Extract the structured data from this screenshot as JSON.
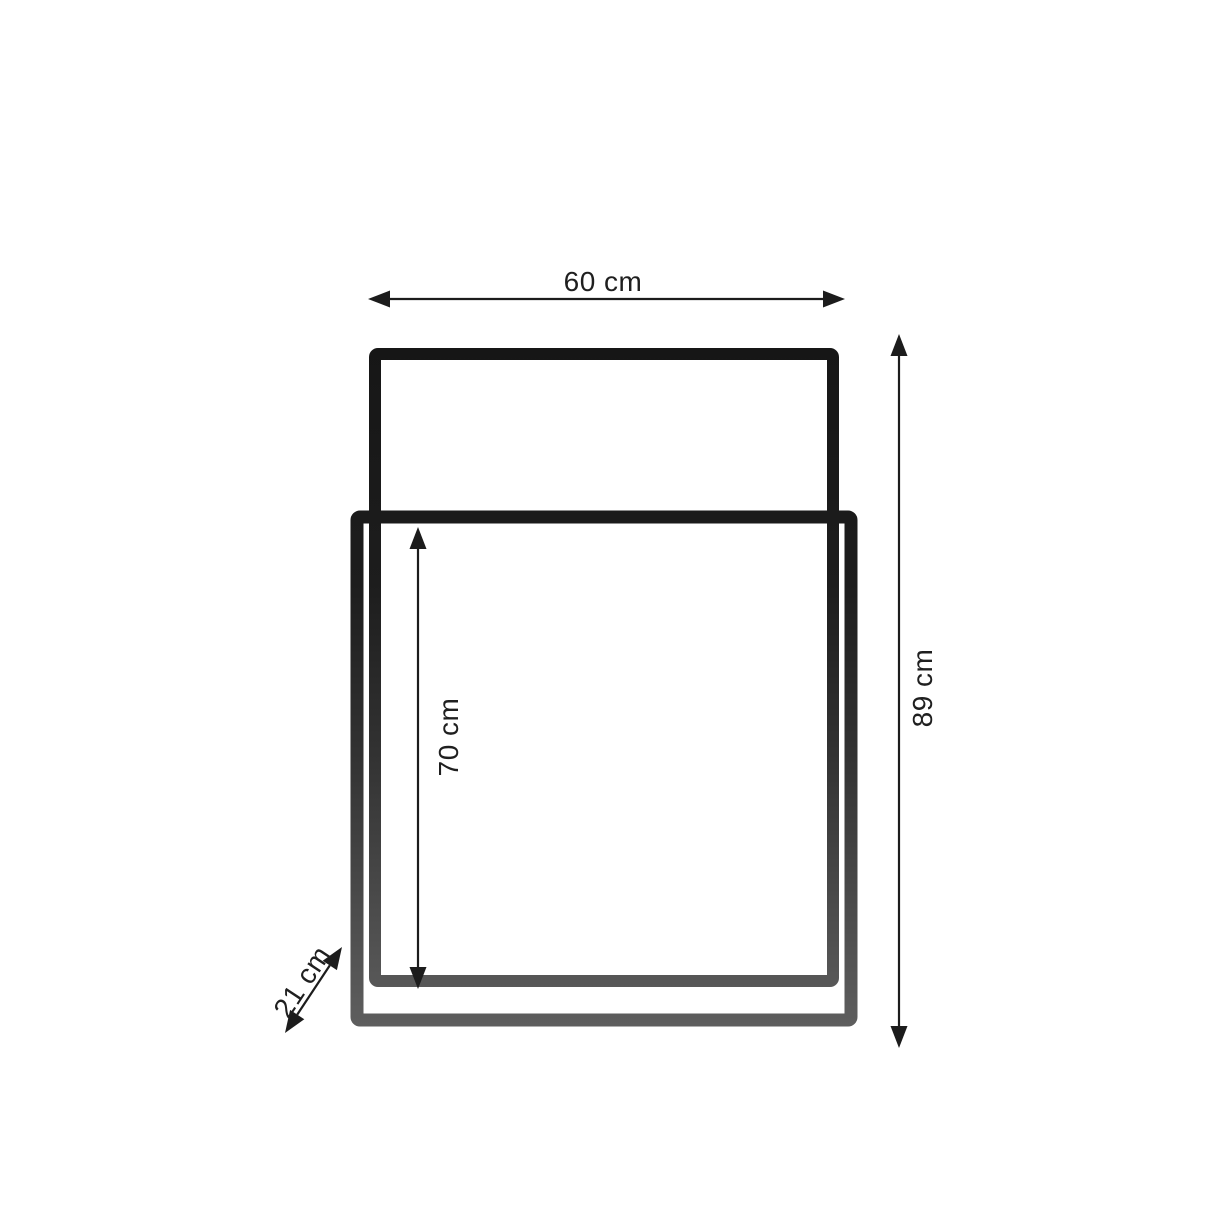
{
  "dimensions": {
    "width": {
      "label": "60 cm",
      "value": 60,
      "unit": "cm"
    },
    "total_height": {
      "label": "89 cm",
      "value": 89,
      "unit": "cm"
    },
    "inner_height": {
      "label": "70 cm",
      "value": 70,
      "unit": "cm"
    },
    "depth": {
      "label": "21 cm",
      "value": 21,
      "unit": "cm"
    }
  },
  "colors": {
    "background": "#ffffff",
    "frame_dark_top": "#191919",
    "frame_gray_bottom": "#5f5f5f",
    "dimension_line": "#1c1c1c",
    "label_text": "#1f1f1f"
  }
}
